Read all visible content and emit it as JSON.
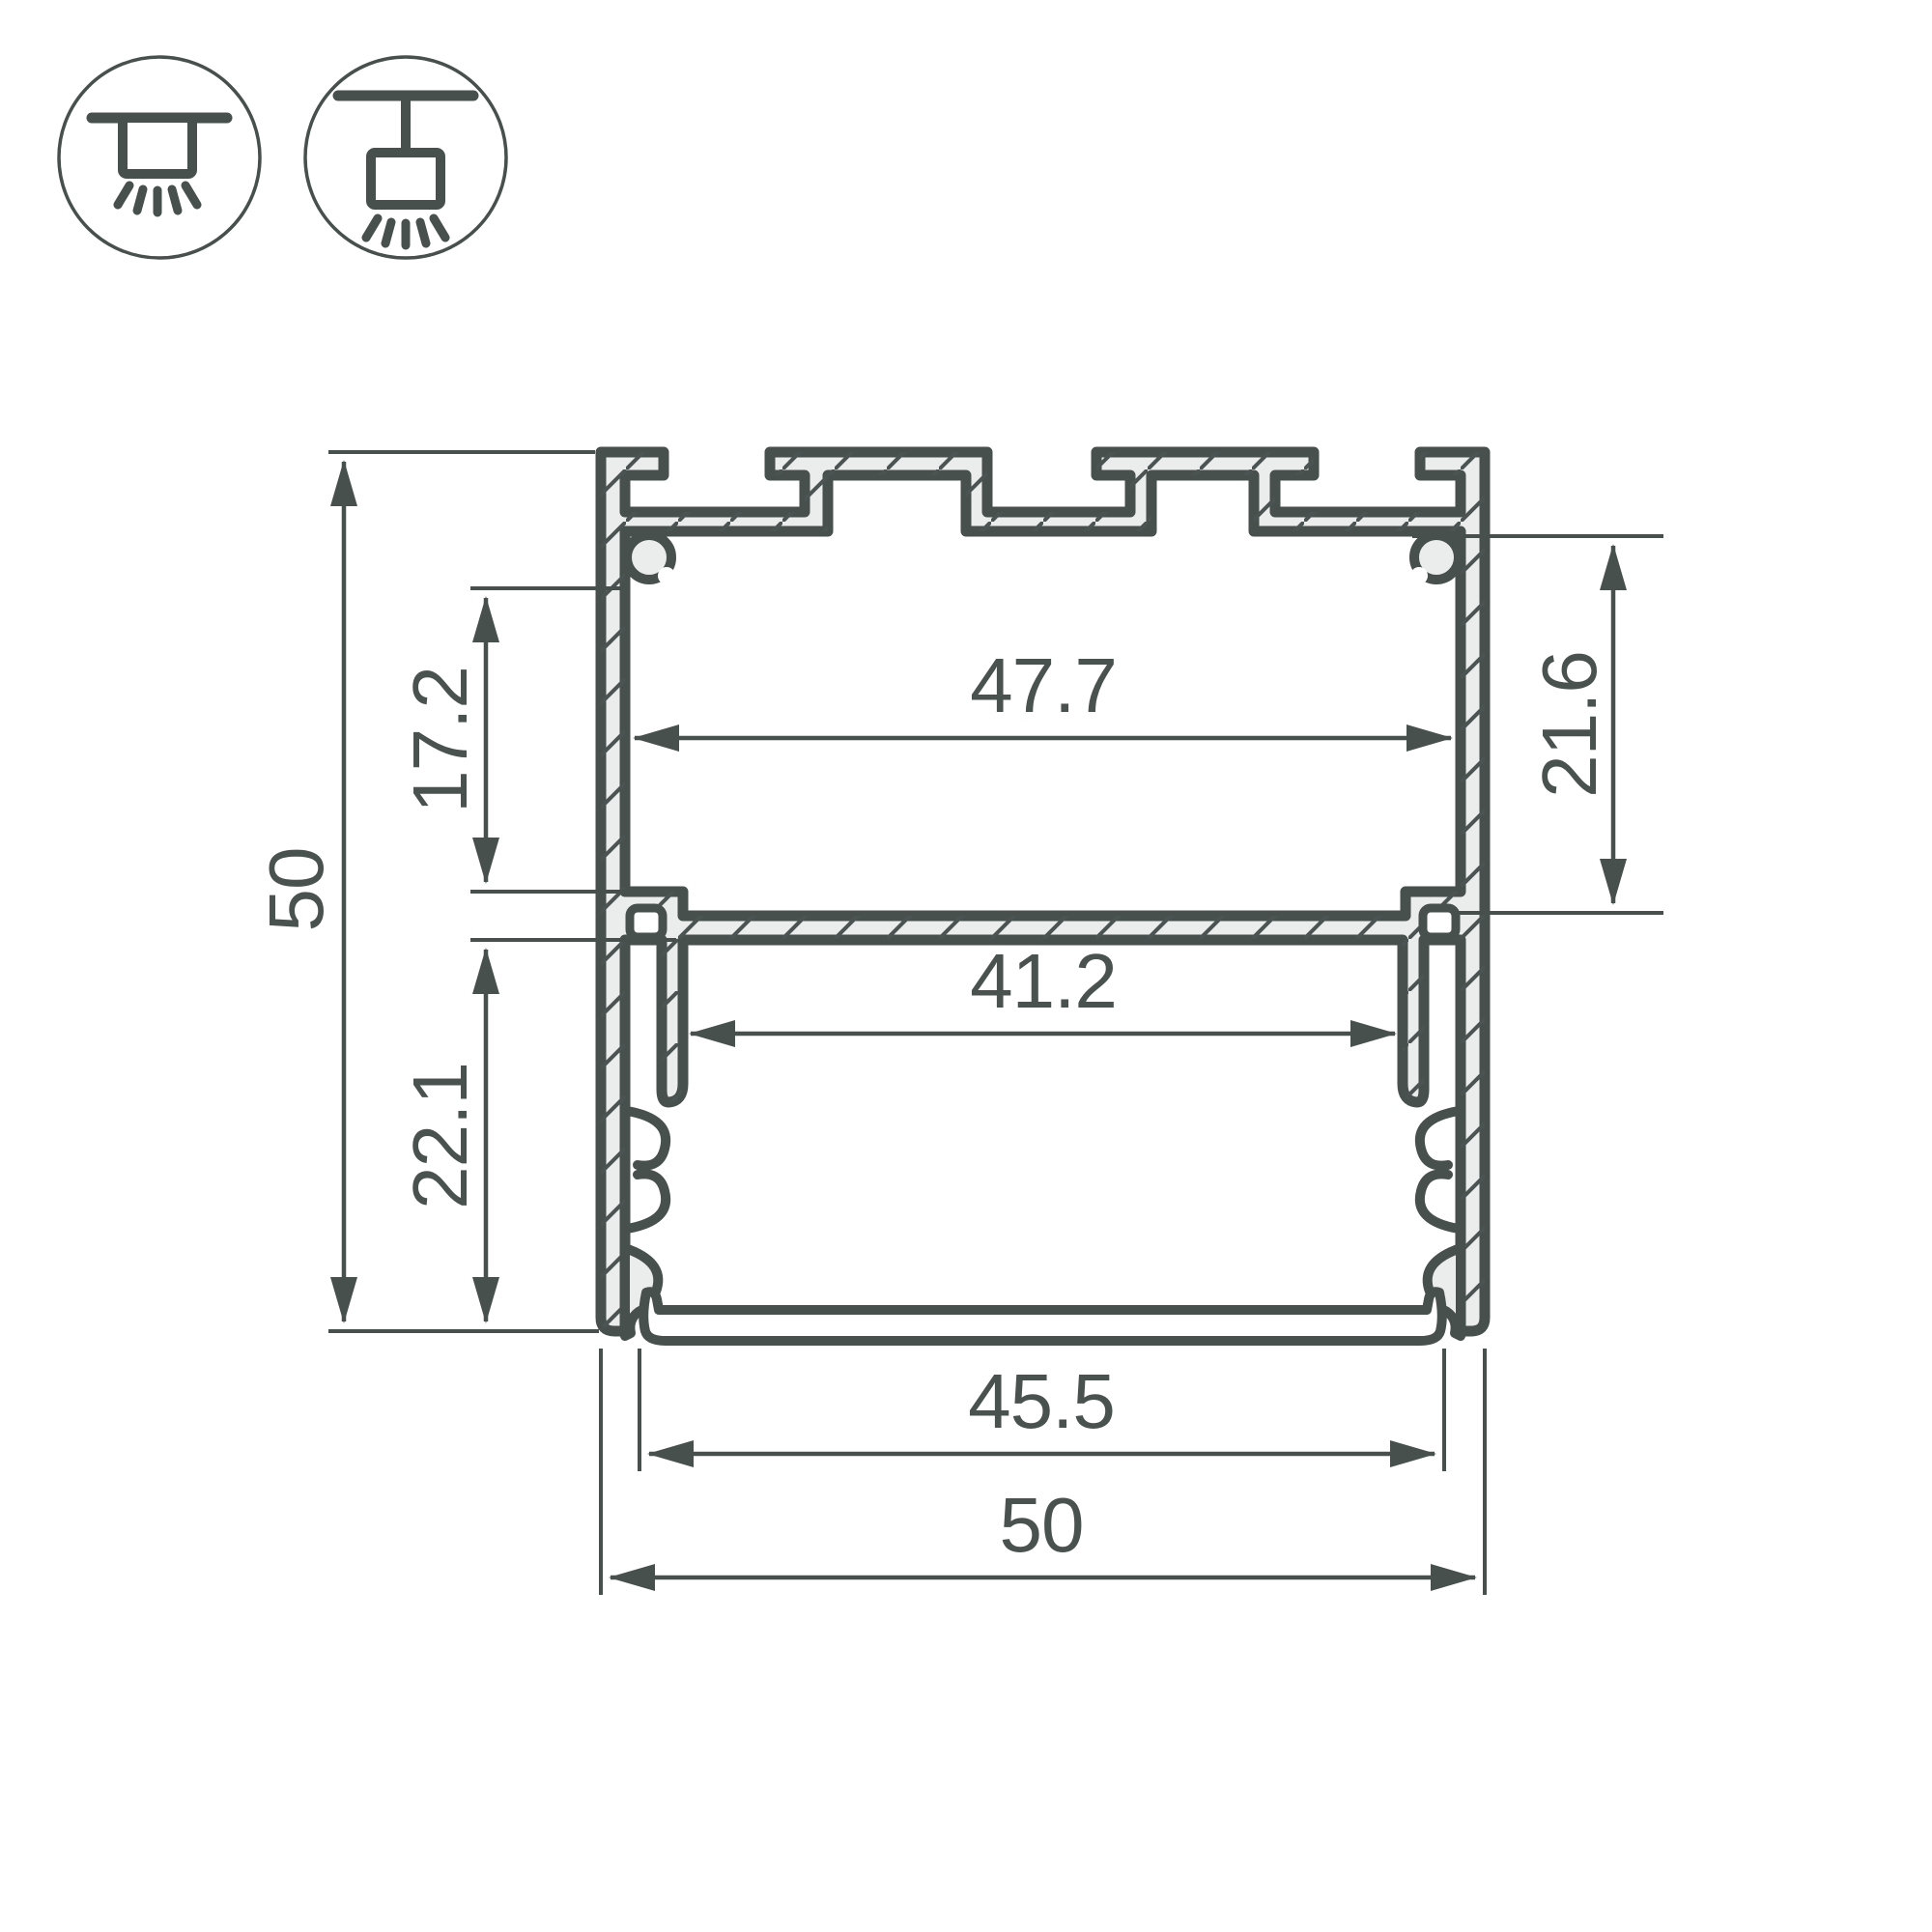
{
  "drawing": {
    "title": "aluminium-led-profile-cross-section",
    "background": "#ffffff",
    "line_color": "#47504d",
    "metal_fill": "#ebedec",
    "text_color": "#4a524f"
  },
  "icons": {
    "surface_mount": "surface-mount-luminaire",
    "pendant_mount": "pendant-mount-luminaire"
  },
  "dimensions": {
    "overall_height": "50",
    "top_cavity_height": "17.2",
    "bottom_cavity_height": "22.1",
    "top_inner_width": "47.7",
    "right_cavity_height": "21.6",
    "bottom_inner_width": "41.2",
    "cover_width": "45.5",
    "overall_width": "50"
  }
}
